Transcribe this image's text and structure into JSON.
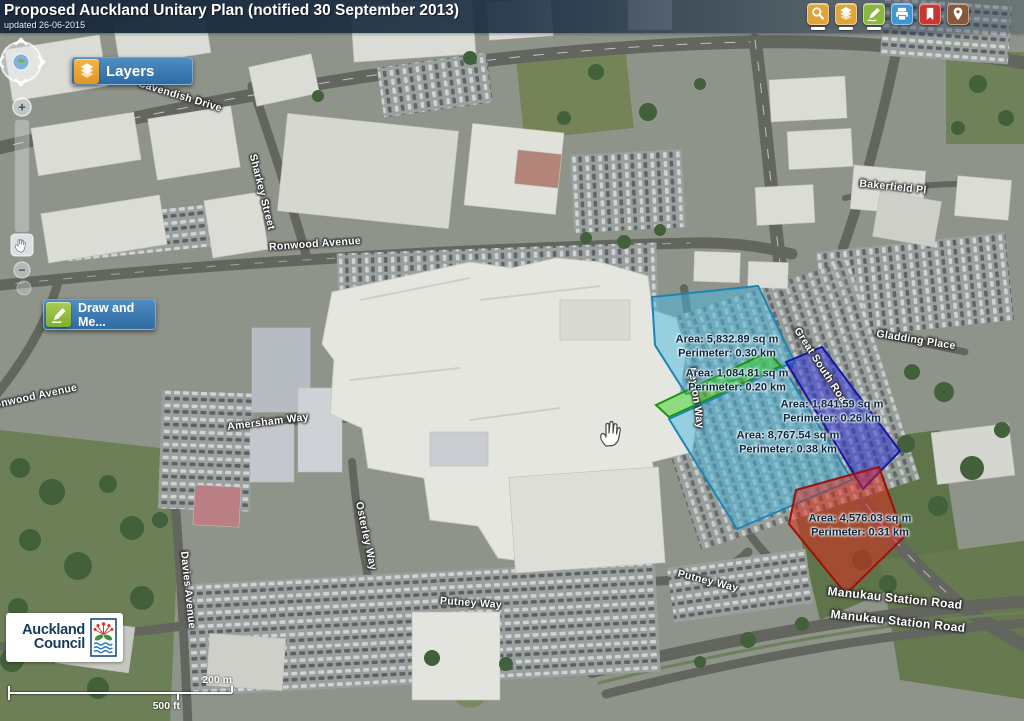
{
  "header": {
    "title": "Proposed Auckland Unitary Plan (notified 30 September 2013)",
    "updated": "updated 26-06-2015"
  },
  "colors": {
    "panel_blue": "#3a78ae",
    "measure": {
      "cyan": {
        "fill": "#45b8df",
        "stroke": "#1b85b5"
      },
      "green": {
        "fill": "#37d21f",
        "stroke": "#1d9111"
      },
      "blue": {
        "fill": "#2a2ee0",
        "stroke": "#1416a8"
      },
      "red": {
        "fill": "#e62619",
        "stroke": "#9c120b"
      }
    }
  },
  "toolbar": [
    {
      "name": "search",
      "icon": "magnifier-icon",
      "color": "#dfa43c",
      "active": true
    },
    {
      "name": "layers",
      "icon": "layers-icon",
      "color": "#dfa43c",
      "active": true
    },
    {
      "name": "draw",
      "icon": "pencil-icon",
      "color": "#8ab83f",
      "active": true
    },
    {
      "name": "print",
      "icon": "printer-icon",
      "color": "#3e97d3",
      "active": false
    },
    {
      "name": "bookmarks",
      "icon": "bookmark-icon",
      "color": "#c43932",
      "active": false
    },
    {
      "name": "locate",
      "icon": "map-pin-icon",
      "color": "#85593a",
      "active": false
    }
  ],
  "layers_button": {
    "label": "Layers"
  },
  "draw_button": {
    "label": "Draw and Me..."
  },
  "nav": {
    "zoom_in": "+",
    "zoom_out": "−"
  },
  "measurements": [
    {
      "color": "cyan",
      "area": "Area: 5,832.89 sq m",
      "perimeter": "Perimeter: 0.30 km",
      "x": 727,
      "y": 347
    },
    {
      "color": "green",
      "area": "Area: 1,084.81 sq m",
      "perimeter": "Perimeter: 0.20 km",
      "x": 737,
      "y": 381
    },
    {
      "color": "blue",
      "area": "Area: 1,841.59 sq m",
      "perimeter": "Perimeter: 0.26 km",
      "x": 832,
      "y": 412
    },
    {
      "color": "cyan",
      "area": "Area: 8,767.54 sq m",
      "perimeter": "Perimeter: 0.38 km",
      "x": 788,
      "y": 443
    },
    {
      "color": "red",
      "area": "Area: 4,576.03 sq m",
      "perimeter": "Perimeter: 0.31 km",
      "x": 860,
      "y": 526
    }
  ],
  "road_labels": [
    {
      "text": "Cavendish Drive",
      "x": 180,
      "y": 96,
      "rot": 17
    },
    {
      "text": "Sharkey Street",
      "x": 262,
      "y": 192,
      "rot": 76
    },
    {
      "text": "Ronwood Avenue",
      "x": 315,
      "y": 244,
      "rot": -4
    },
    {
      "text": "Ronwood Avenue",
      "x": 32,
      "y": 397,
      "rot": -12
    },
    {
      "text": "Bakerfield Pl",
      "x": 893,
      "y": 187,
      "rot": 6
    },
    {
      "text": "Gladding Place",
      "x": 916,
      "y": 340,
      "rot": 9
    },
    {
      "text": "Great South Road",
      "x": 822,
      "y": 368,
      "rot": 57
    },
    {
      "text": "Amersham Way",
      "x": 268,
      "y": 422,
      "rot": -7
    },
    {
      "text": "Leyton Way",
      "x": 696,
      "y": 398,
      "rot": 82
    },
    {
      "text": "Osterley Way",
      "x": 366,
      "y": 536,
      "rot": 78
    },
    {
      "text": "Davies Avenue",
      "x": 188,
      "y": 590,
      "rot": 84
    },
    {
      "text": "Putney Way",
      "x": 471,
      "y": 603,
      "rot": 4
    },
    {
      "text": "Putney Way",
      "x": 708,
      "y": 581,
      "rot": 14
    },
    {
      "text": "Manukau Station Road",
      "x": 895,
      "y": 598,
      "rot": 6,
      "size": 12
    },
    {
      "text": "Manukau Station Road",
      "x": 898,
      "y": 621,
      "rot": 6,
      "size": 12
    }
  ],
  "scalebar": {
    "metric": "200 m",
    "imperial": "500 ft"
  },
  "logo": {
    "line1": "Auckland",
    "line2": "Council"
  }
}
